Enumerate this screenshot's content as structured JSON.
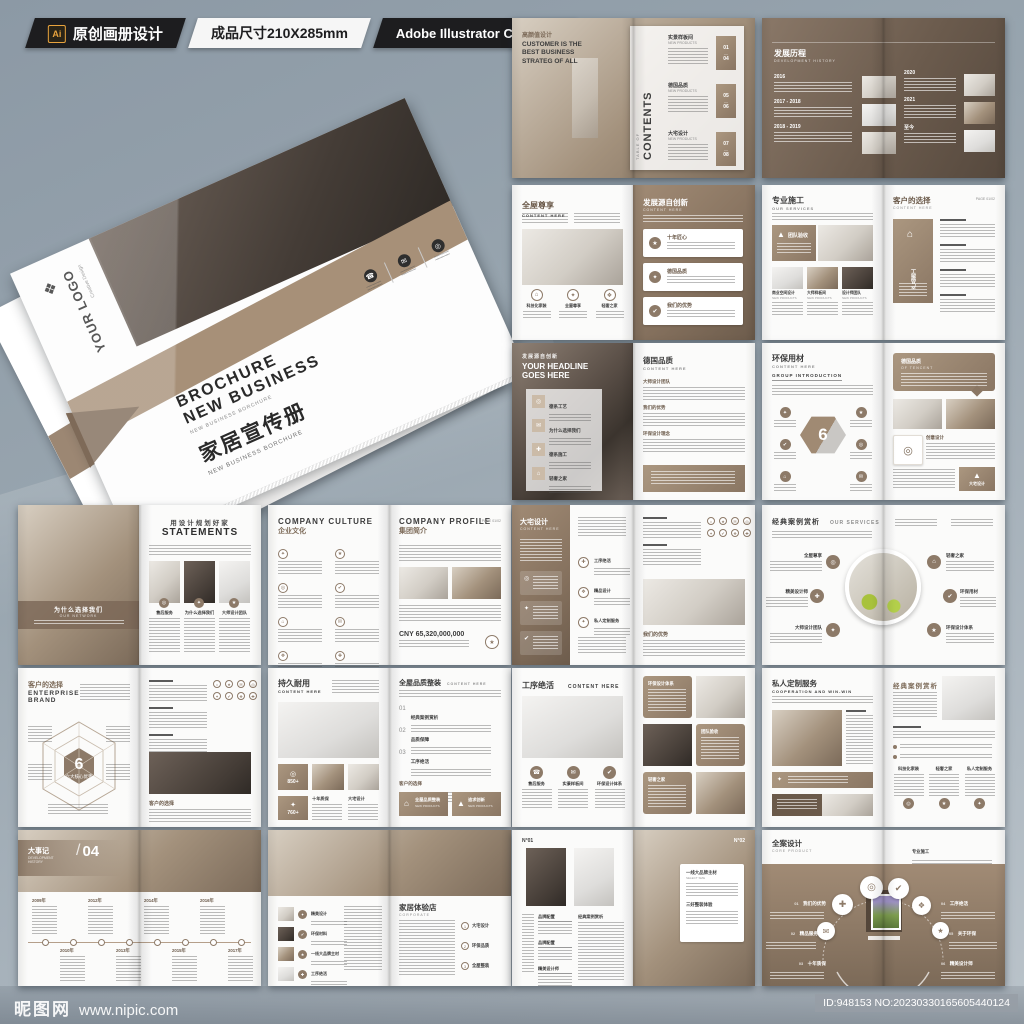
{
  "header": {
    "ai_badge": "Ai",
    "original_label": "原创画册设计",
    "size_label": "成品尺寸210X285mm",
    "software_label": "Adobe Illustrator CC 2018"
  },
  "cover": {
    "logo_text": "YOUR LOGO",
    "logo_sub": "Creative Design",
    "title_en1": "BROCHURE",
    "title_en2": "NEW BUSINESS",
    "title_en_sub": "NEW BUSINESS BORCHURE",
    "title_cn": "家居宣传册",
    "title_cn_sub": "NEW BUSINESS BORCHURE"
  },
  "icons": {
    "phone": "☎",
    "mail": "✉",
    "home": "⌂",
    "rocket": "▲",
    "target": "◎",
    "spark": "✦",
    "diamond": "❖",
    "star": "★",
    "check": "✔",
    "dot": "●",
    "plus": "✚"
  },
  "spreads": {
    "contents": {
      "left_tag": "高颜值设计",
      "left_heading": "CUSTOMER IS THE BEST BUSINESS STRATEG OF ALL",
      "toc_label": "TABLE OF",
      "toc_title": "CONTENTS",
      "sections": [
        {
          "title": "实景样板间",
          "sub": "NEW PRODUCTS",
          "from": "01",
          "to": "04"
        },
        {
          "title": "德国品质",
          "sub": "NEW PRODUCTS",
          "from": "05",
          "to": "06"
        },
        {
          "title": "大宅设计",
          "sub": "NEW PRODUCTS",
          "from": "07",
          "to": "08"
        }
      ]
    },
    "history": {
      "title_cn": "发展历程",
      "title_en": "DEVELOPMENT HISTORY",
      "years": [
        "2016",
        "2017 - 2018",
        "2018 - 2019",
        "2020",
        "2021",
        "至今"
      ]
    },
    "whole_house": {
      "left_title": "全屋尊享",
      "left_sub": "CONTENT HERE",
      "features": [
        "科技化家装",
        "全屋尊享",
        "轻奢之家"
      ],
      "right_title": "发展源自创新",
      "right_sub": "CONTENT HERE",
      "cards": [
        "十年匠心",
        "德国品质",
        "我们的优势"
      ]
    },
    "construction": {
      "left_title": "专业施工",
      "left_sub": "OUR SERVICES",
      "banner": "团队验收",
      "thumb_sub": "NEW PRODUCTS",
      "thumbs": [
        "商业空间设计",
        "大师样板间",
        "设计师团队"
      ],
      "right_title": "客户的选择",
      "right_sub": "CONTENT HERE",
      "page_no": "PAGE 01/02",
      "card_label": "产品施工"
    },
    "headline": {
      "tag": "发展源自创新",
      "heading1": "YOUR HEADLINE",
      "heading2": "GOES HERE",
      "list": [
        "德系工艺",
        "为什么选择我们",
        "德系施工",
        "轻奢之家"
      ],
      "right_title": "德国品质",
      "right_sub": "CONTENT HERE",
      "right_sections": [
        "大师设计团队",
        "我们的优势",
        "环保设计理念"
      ]
    },
    "materials": {
      "left_title": "环保用材",
      "left_sub": "CONTENT HERE",
      "group": "GROUP INTRODUCTION",
      "hex_number": "6",
      "bubble_cn": "德国品质",
      "bubble_en": "OF TENCENT",
      "card1": "创意设计",
      "card2": "大宅设计"
    },
    "statements": {
      "band_cn": "为什么选择我们",
      "band_en": "OUR NETWORK",
      "title_cn": "用设计规划好家",
      "title_en": "STATEMENTS",
      "captions": [
        "售后服务",
        "为什么选择我们",
        "大师设计团队"
      ]
    },
    "company": {
      "culture_en": "COMPANY CULTURE",
      "culture_cn": "企业文化",
      "profile_en": "COMPANY PROFILE",
      "profile_cn": "集团简介",
      "page_no": "PAGE 01/02",
      "figure": "CNY 65,320,000,000"
    },
    "mansion": {
      "title": "大宅设计",
      "sub": "CONTENT HERE",
      "mid_items": [
        "工序绝活",
        "精品设计",
        "私人定制服务"
      ],
      "right_heading": "我们的优势"
    },
    "cases": {
      "title_cn": "经典案例赏析",
      "title_en": "OUR SERVICES",
      "left_labels": [
        "全屋尊享",
        "精美设计师",
        "大师设计团队"
      ],
      "right_labels": [
        "轻奢之家",
        "环保用材",
        "环保设计体系"
      ]
    },
    "brand": {
      "title_cn": "客户的选择",
      "title_en1": "ENTERPRISE",
      "title_en2": "BRAND",
      "hex_number": "6",
      "hex_label": "六大核心优势",
      "right_heading": "客户的选择"
    },
    "durable": {
      "left_title": "持久耐用",
      "left_sub": "CONTENT HERE",
      "stat1": "850+",
      "stat2": "760+",
      "captions": [
        "十年质保",
        "大宅设计"
      ],
      "right_title": "全屋品质整装",
      "right_sub": "CONTENT HERE",
      "numbered": [
        {
          "no": "01",
          "t": "经典案例赏析"
        },
        {
          "no": "02",
          "t": "品质保障"
        },
        {
          "no": "03",
          "t": "工序绝活"
        }
      ],
      "para_heading": "客户的选择",
      "cards": [
        {
          "t": "全屋品质整装",
          "s": "NEW PRODUCTS"
        },
        {
          "t": "追求创新",
          "s": "NEW PRODUCTS"
        }
      ]
    },
    "craft": {
      "title": "工序绝活",
      "sub": "CONTENT HERE",
      "features": [
        "售后服务",
        "实景样板间",
        "环保设计体系"
      ],
      "bubbles": [
        "环保设计体系",
        "团队验收",
        "轻奢之家"
      ]
    },
    "custom": {
      "title_cn": "私人定制服务",
      "title_en": "COOPERATION AND WIN-WIN",
      "right_title": "经典案例赏析",
      "cols": [
        "科技化家装",
        "轻奢之家",
        "私人定制服务"
      ]
    },
    "milestones": {
      "title_cn": "大事记",
      "title_en1": "DEVELOPMENT",
      "title_en2": "HISTORY",
      "number": "04",
      "years": [
        "2009年",
        "2010年",
        "2012年",
        "2013年",
        "2014年",
        "2015年",
        "2016年",
        "2017年"
      ]
    },
    "showroom": {
      "labels": [
        "精美设计",
        "环保材料",
        "一线大品牌主材",
        "工序绝活"
      ],
      "title_cn": "家居体验店",
      "title_en": "CORPORATE",
      "list": [
        "大宅设计",
        "环保品质",
        "全屋整装"
      ],
      "nums": [
        "1",
        "2",
        "3"
      ]
    },
    "numbered_pages": {
      "no1": "N°01",
      "no2": "N°02",
      "col_heads": [
        "品牌配置",
        "品牌配置",
        "精美设计师",
        "经典案例赏析"
      ],
      "card_title": "一线大品牌主材",
      "card_sub": "SELECT SIZE",
      "card_title2": "三好整装体验"
    },
    "core": {
      "title_cn": "全案设计",
      "title_en": "CORE PRODUCT",
      "top_right": "专业施工",
      "left_labels": [
        {
          "no": "01",
          "t": "我们的优势"
        },
        {
          "no": "02",
          "t": "精品服务"
        },
        {
          "no": "03",
          "t": "十年质保"
        }
      ],
      "right_labels": [
        {
          "no": "04",
          "t": "工序绝活"
        },
        {
          "no": "05",
          "t": "关于环保"
        },
        {
          "no": "06",
          "t": "精美设计师"
        }
      ]
    }
  },
  "footer": {
    "site_name": "昵图网",
    "site_url": "www.nipic.com",
    "id_text": "ID:948153 NO:20230330165605440124"
  },
  "colors": {
    "accent_brown": "#8d7a68",
    "dark_brown": "#6d5c4c",
    "panel_black": "#1d1d1f",
    "bg_top": "#8c99a5",
    "bg_bottom": "#bac3ca"
  }
}
